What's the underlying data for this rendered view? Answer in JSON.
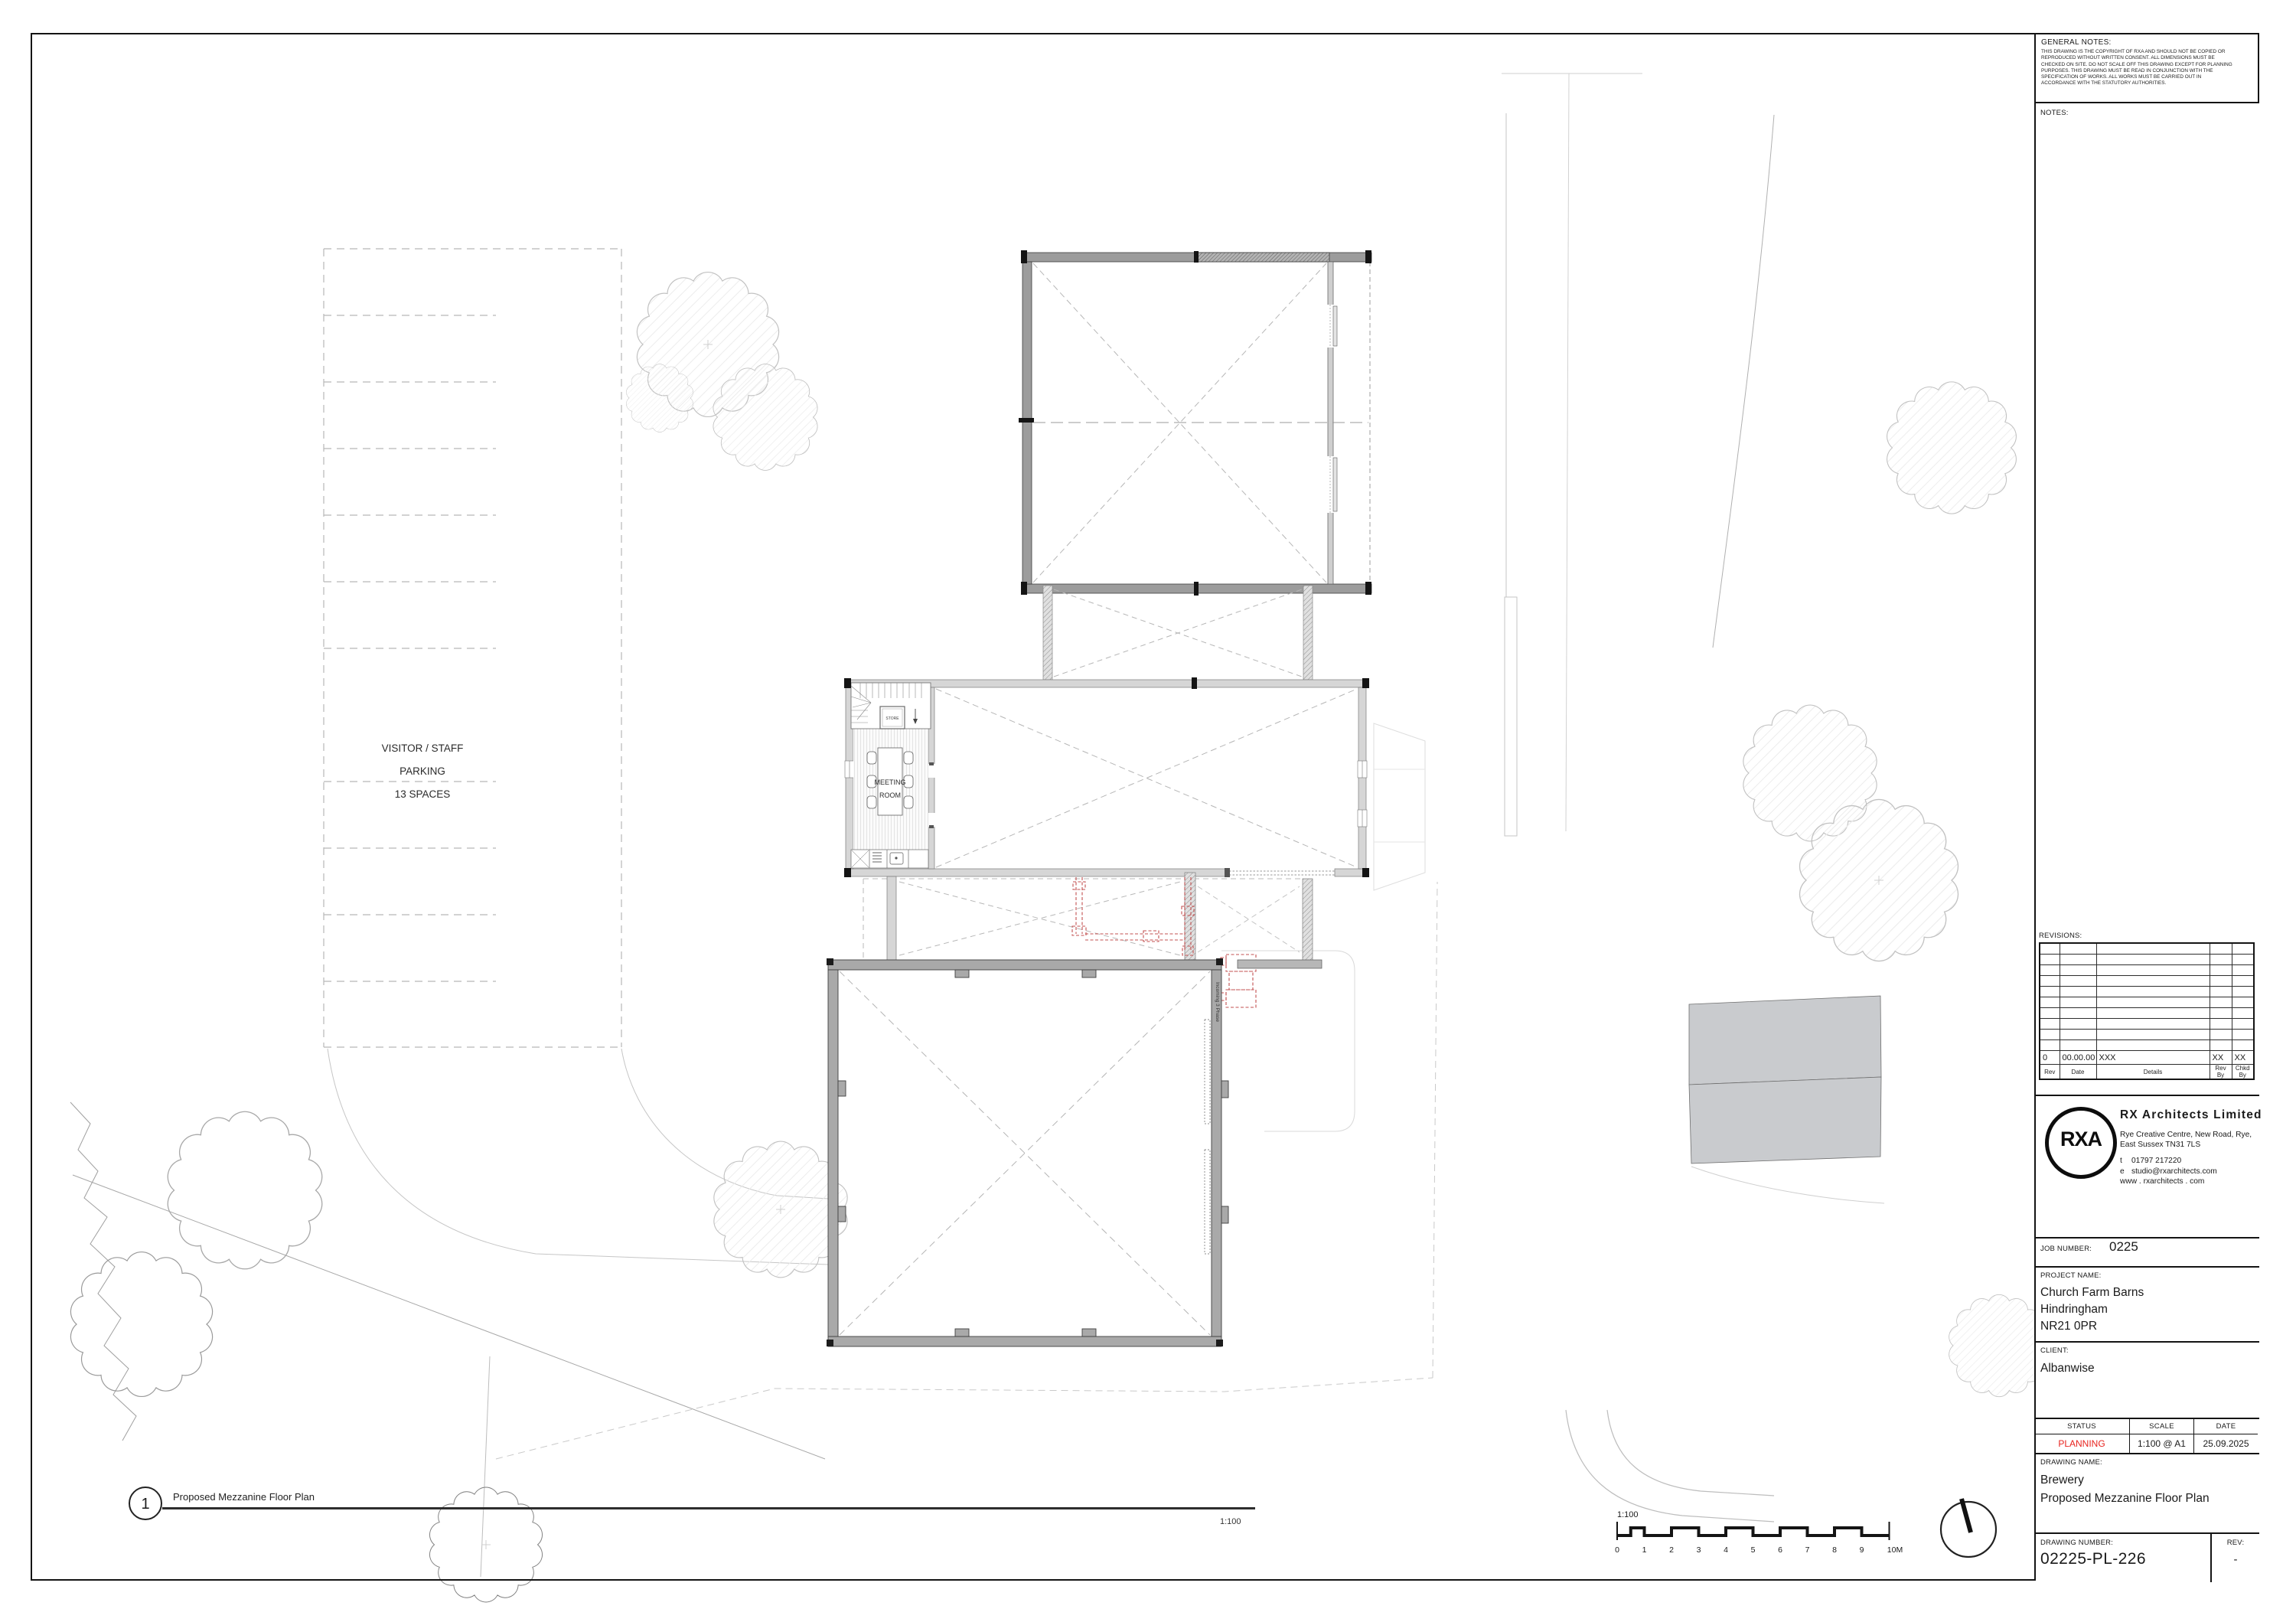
{
  "title_block": {
    "general_notes": {
      "title": "GENERAL NOTES:",
      "body": "THIS DRAWING IS THE COPYRIGHT OF RXA AND SHOULD NOT BE COPIED OR REPRODUCED WITHOUT WRITTEN CONSENT. ALL DIMENSIONS MUST BE CHECKED ON SITE. DO NOT SCALE OFF THIS DRAWING EXCEPT FOR PLANNING PURPOSES. THIS DRAWING MUST BE READ IN CONJUNCTION WITH THE SPECIFICATION OF WORKS. ALL WORKS MUST BE CARRIED OUT IN ACCORDANCE WITH THE STATUTORY AUTHORITIES."
    },
    "notes_label": "NOTES:",
    "revisions": {
      "label": "REVISIONS:",
      "entry": {
        "rev": "0",
        "date": "00.00.00",
        "details": "XXX",
        "rev_by": "XX",
        "chkd_by": "XX"
      },
      "headers": {
        "rev": "Rev",
        "date": "Date",
        "details": "Details",
        "rev_by": "Rev By",
        "chkd_by": "Chkd By"
      }
    },
    "firm": {
      "logo": "RXA",
      "name": "RX  Architects  Limited",
      "address_line1": "Rye Creative Centre,  New Road,  Rye,",
      "address_line2": "East Sussex  TN31 7LS",
      "phone_prefix": "t",
      "phone": "01797 217220",
      "email_prefix": "e",
      "email": "studio@rxarchitects.com",
      "website": "www . rxarchitects . com"
    },
    "job": {
      "label": "JOB NUMBER:",
      "value": "0225"
    },
    "project": {
      "label": "PROJECT NAME:",
      "line1": "Church Farm Barns",
      "line2": "Hindringham",
      "line3": "NR21 0PR"
    },
    "client": {
      "label": "CLIENT:",
      "value": "Albanwise"
    },
    "status_row": {
      "status_label": "STATUS",
      "scale_label": "SCALE",
      "date_label": "DATE",
      "status": "PLANNING",
      "scale": "1:100 @ A1",
      "date": "25.09.2025",
      "status_color": "#e8231e"
    },
    "drawing_name": {
      "label": "DRAWING NAME:",
      "line1": "Brewery",
      "line2": "Proposed Mezzanine Floor Plan"
    },
    "drawing_number": {
      "label": "DRAWING NUMBER:",
      "value": "02225-PL-226",
      "rev_label": "REV:",
      "rev_value": "-"
    }
  },
  "plan": {
    "view_title": {
      "number": "1",
      "name": "Proposed Mezzanine Floor Plan",
      "scale": "1:100"
    },
    "labels": {
      "parking": [
        "VISITOR / STAFF",
        "PARKING",
        "13 SPACES"
      ],
      "meeting_room": [
        "MEETING",
        "ROOM"
      ],
      "store": "STORE",
      "incoming_power": "Incoming 3 Phase"
    },
    "scalebar": {
      "label": "1:100",
      "units": [
        "0",
        "1",
        "2",
        "3",
        "4",
        "5",
        "6",
        "7",
        "8",
        "9",
        "10M"
      ]
    }
  },
  "colors": {
    "status_red": "#e8231e",
    "services_red": "#c35050",
    "wall_dark_gray": "#a9a9a9",
    "wall_light_gray": "#d6d6d6",
    "shaded_building_gray": "#c9cbce"
  }
}
